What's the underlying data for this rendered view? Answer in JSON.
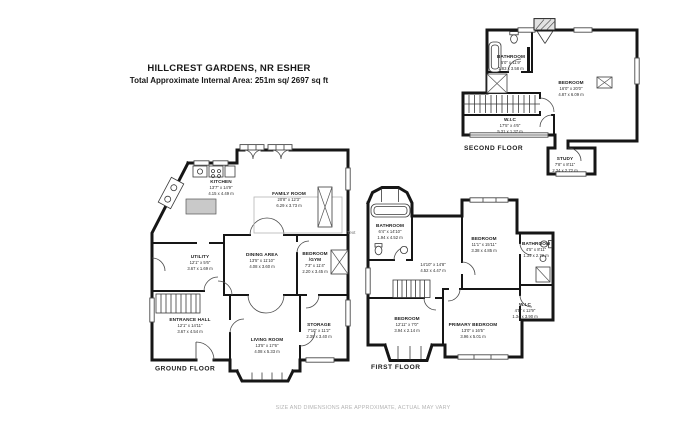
{
  "header": {
    "title": "HILLCREST GARDENS, NR ESHER",
    "subtitle": "Total Approximate Internal Area: 251m sq/ 2697 sq ft"
  },
  "footer": {
    "disclaimer": "SIZE AND DIMENSIONS ARE APPROXIMATE, ACTUAL MAY VARY"
  },
  "annotation": "Text",
  "colors": {
    "wall": "#161616",
    "text": "#1c1c1c",
    "muted": "#b4b4b4"
  },
  "floors": {
    "ground": {
      "label": "GROUND FLOOR",
      "rooms": {
        "kitchen": {
          "name": "KITCHEN",
          "imperial": "13'7\" x 14'9\"",
          "metric": "4.15 x 4.49 m"
        },
        "family": {
          "name": "FAMILY ROOM",
          "imperial": "20'8\" x 12'3\"",
          "metric": "6.29 x 3.73 m"
        },
        "utility": {
          "name": "UTILITY",
          "imperial": "12'1\" x 5'6\"",
          "metric": "3.67 x 1.69 m"
        },
        "dining": {
          "name": "DINING AREA",
          "imperial": "13'5\" x 11'10\"",
          "metric": "4.08 x 3.60 m"
        },
        "gym": {
          "name": "BEDROOM",
          "alt": "/GYM",
          "imperial": "7'3\" x 11'4\"",
          "metric": "2.20 x 3.45 m"
        },
        "entrance": {
          "name": "ENTRANCE HALL",
          "imperial": "12'1\" x 14'11\"",
          "metric": "3.67 x 4.54 m"
        },
        "living": {
          "name": "LIVING ROOM",
          "imperial": "13'5\" x 17'6\"",
          "metric": "4.08 x 5.33 m"
        },
        "storage": {
          "name": "STORAGE",
          "imperial": "7'10\" x 11'2\"",
          "metric": "2.39 x 3.40 m"
        }
      }
    },
    "first": {
      "label": "FIRST FLOOR",
      "rooms": {
        "bathroom1": {
          "name": "BATHROOM",
          "imperial": "6'4\" x 14'10\"",
          "metric": "1.94 x 4.52 m"
        },
        "bedroom1": {
          "name": "BEDROOM",
          "imperial": "11'1\" x 15'11\"",
          "metric": "3.38 x 4.85 m"
        },
        "bathroom2": {
          "name": "BATHROOM",
          "imperial": "4'5\" x 8'11\"",
          "metric": "1.34 x 2.72 m"
        },
        "landing": {
          "imperial": "14'10\" x 14'8\"",
          "metric": "4.52 x 4.47 m"
        },
        "bedroom2": {
          "name": "BEDROOM",
          "imperial": "12'11\" x 7'0\"",
          "metric": "3.94 x 2.14 m"
        },
        "primary": {
          "name": "PRIMARY BEDROOM",
          "imperial": "13'0\" x 16'5\"",
          "metric": "3.96 x 5.01 m"
        },
        "wic": {
          "name": "W.I.C",
          "imperial": "4'5\" x 12'9\"",
          "metric": "1.34 x 3.90 m"
        }
      }
    },
    "second": {
      "label": "SECOND FLOOR",
      "rooms": {
        "bathroom": {
          "name": "BATHROOM",
          "imperial": "6'0\" x 11'9\"",
          "metric": "1.83 x 3.58 m"
        },
        "bedroom": {
          "name": "BEDROOM",
          "imperial": "16'0\" x 20'0\"",
          "metric": "4.87 x 6.09 m"
        },
        "wic": {
          "name": "W.I.C",
          "imperial": "17'5\" x 4'6\"",
          "metric": "5.31 x 1.37 m"
        },
        "study": {
          "name": "STUDY",
          "imperial": "7'8\" x 8'11\"",
          "metric": "2.34 x 2.72 m"
        }
      }
    }
  }
}
